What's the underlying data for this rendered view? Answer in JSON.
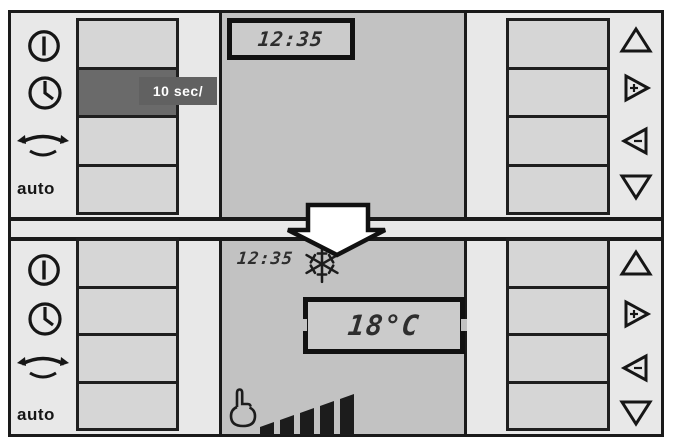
{
  "colors": {
    "panel_bg": "#e8e8e8",
    "display_bg": "#c2c2c2",
    "button_bg": "#d6d6d6",
    "button_active_bg": "#6a6a6a",
    "outline": "#1a1a1a",
    "hint_label_bg": "#616161",
    "hint_label_text": "#ffffff",
    "lcd_text": "#2e2e2e"
  },
  "top_panel": {
    "time": "12:35",
    "hint_label": "10 sec/",
    "auto_label": "auto",
    "active_button": "timer-row-button-pressed",
    "left_icons": [
      "power-icon",
      "timer-clock-icon",
      "swing-icon",
      "auto-label"
    ],
    "right_icons": [
      "up-triangle-icon",
      "plus-right-triangle-icon",
      "minus-left-triangle-icon",
      "down-triangle-icon"
    ]
  },
  "bottom_panel": {
    "time": "12:35",
    "temperature_display": "18°C",
    "mode_icon": "snowflake-cooling-icon",
    "fan_indicator": {
      "icon": "manual-hand-icon",
      "bars_total": 5,
      "bars_active": 5
    },
    "auto_label": "auto",
    "left_icons": [
      "power-icon",
      "timer-clock-icon",
      "swing-icon",
      "auto-label"
    ],
    "right_icons": [
      "up-triangle-icon",
      "plus-right-triangle-icon",
      "minus-left-triangle-icon",
      "down-triangle-icon"
    ]
  },
  "transition": {
    "arrow_icon": "down-block-arrow"
  }
}
